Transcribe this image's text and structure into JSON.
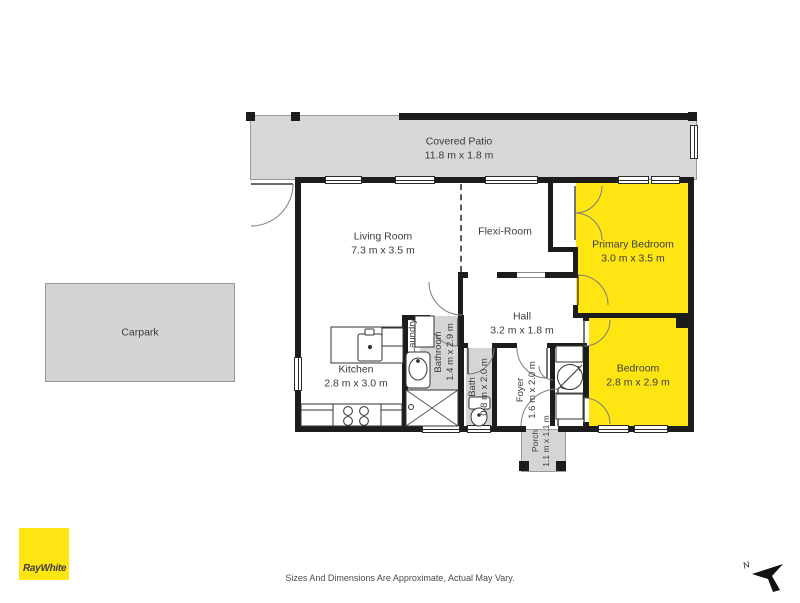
{
  "branding": {
    "logo_text": "RayWhite"
  },
  "footer": {
    "disclaimer": "Sizes And Dimensions Are Approximate, Actual May Vary.",
    "north_label": "N"
  },
  "rooms": {
    "covered_patio": {
      "name": "Covered Patio",
      "dims": "11.8 m x 1.8 m"
    },
    "living_room": {
      "name": "Living Room",
      "dims": "7.3 m x 3.5 m"
    },
    "flexi_room": {
      "name": "Flexi-Room",
      "dims": ""
    },
    "primary_bedroom": {
      "name": "Primary Bedroom",
      "dims": "3.0 m x 3.5 m"
    },
    "bedroom": {
      "name": "Bedroom",
      "dims": "2.8 m x 2.9 m"
    },
    "hall": {
      "name": "Hall",
      "dims": "3.2 m x 1.8 m"
    },
    "kitchen": {
      "name": "Kitchen",
      "dims": "2.8 m x 3.0 m"
    },
    "laundry": {
      "name": "Laundry",
      "dims": ""
    },
    "bathroom": {
      "name": "Bathroom",
      "dims": "1.4 m x 2.9 m"
    },
    "bath": {
      "name": "Bath",
      "dims": "0.8 m x 2.0 m"
    },
    "foyer": {
      "name": "Foyer",
      "dims": "1.6 m x 2.0 m"
    },
    "porch": {
      "name": "Porch",
      "dims": "1.1 m x 1.1 m"
    },
    "carpark": {
      "name": "Carpark",
      "dims": ""
    }
  },
  "colors": {
    "highlight_yellow": "#FFE512",
    "floor_gray": "#D7D7D7",
    "wall_black": "#1C1C1C",
    "label_text": "#3B3B3B"
  }
}
